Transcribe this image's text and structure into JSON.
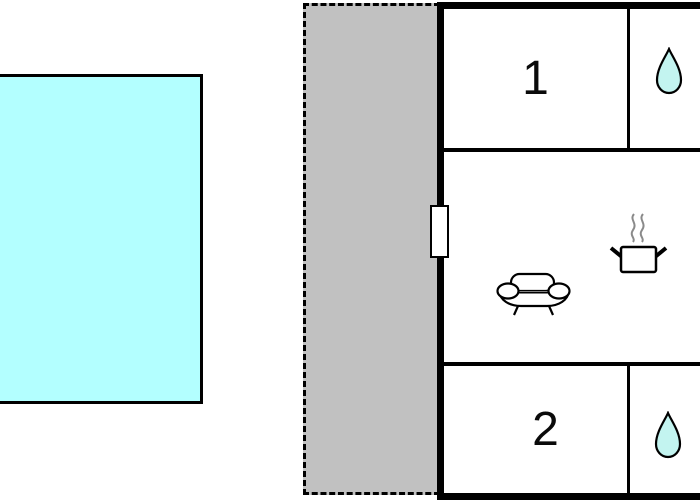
{
  "floorplan": {
    "rooms": [
      {
        "id": "bedroom-1",
        "label": "1"
      },
      {
        "id": "bedroom-2",
        "label": "2"
      }
    ],
    "icons": {
      "bathroom_1": "water-drop-icon",
      "bathroom_2": "water-drop-icon",
      "living_room": "sofa-icon",
      "kitchen": "cooking-pot-icon",
      "entrance": "door"
    },
    "colors": {
      "pool_fill": "#b3ffff",
      "terrace_fill": "#c1c1c1",
      "droplet_fill": "#c3f4f0",
      "icon_fill": "#ffffff",
      "wall": "#000000",
      "steam": "#8a8a8a"
    }
  }
}
